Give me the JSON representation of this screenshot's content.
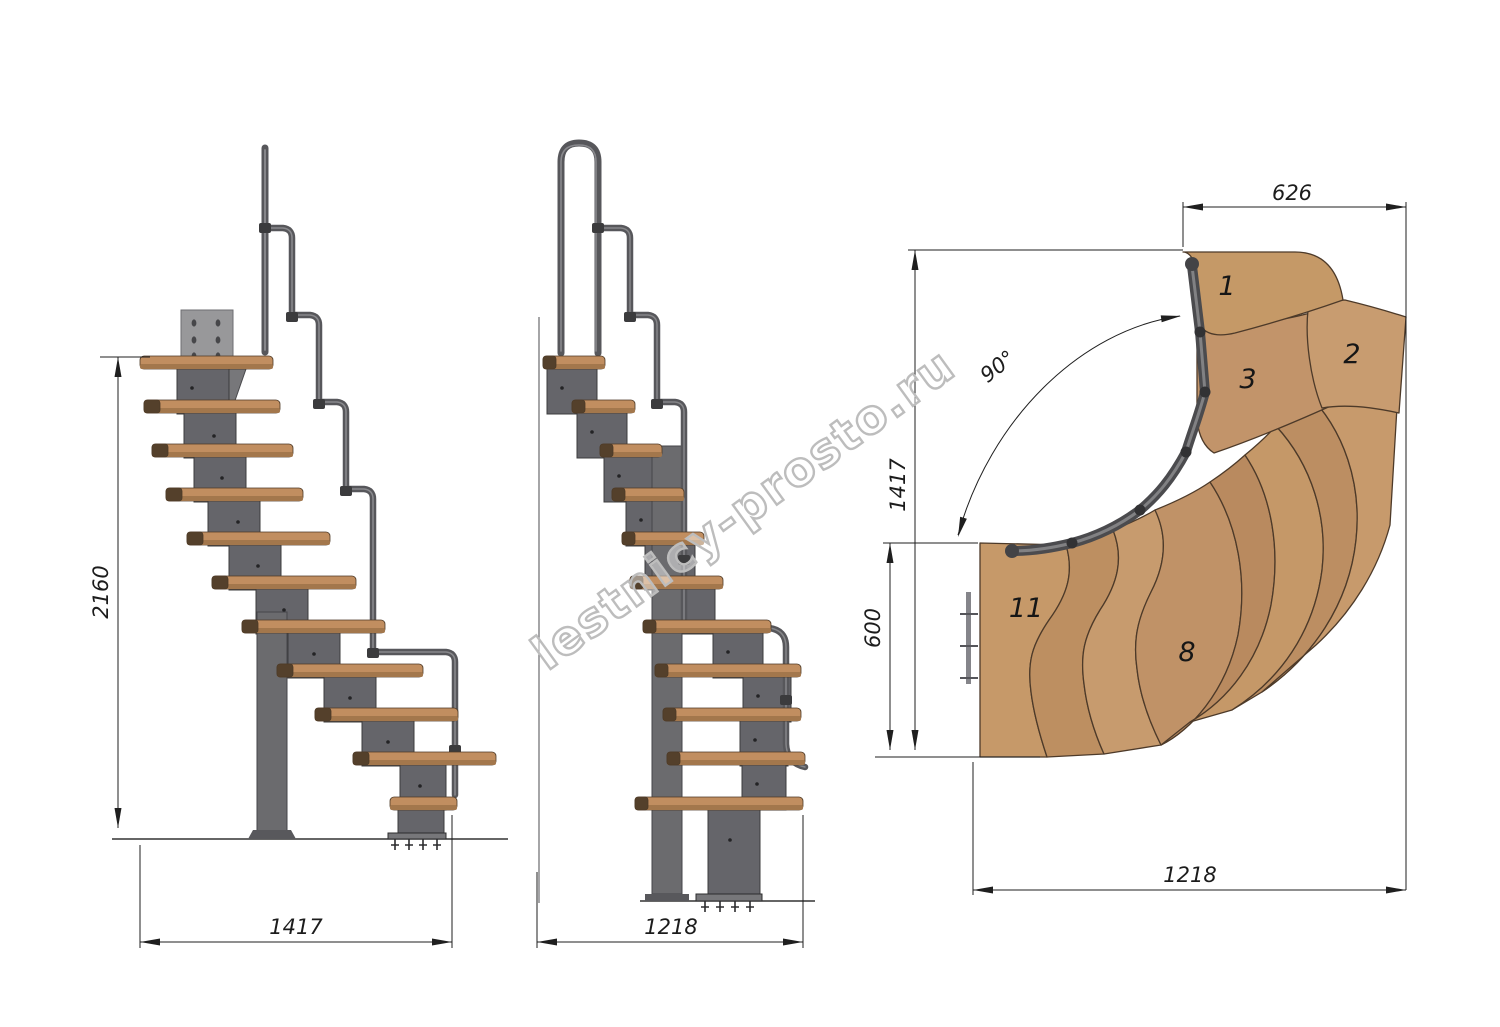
{
  "drawing_title": "Modular 90-degree turn staircase technical drawing",
  "watermark": {
    "text": "lestnicy-prosto.ru"
  },
  "views": {
    "side": {
      "height_dim": "2160",
      "width_dim": "1417"
    },
    "front": {
      "width_dim": "1218"
    },
    "plan": {
      "top_width_dim": "626",
      "flight_length_dim": "1417",
      "lower_width_dim": "600",
      "bottom_width_dim": "1218",
      "turn_angle": "90°",
      "tread_numbers": [
        "1",
        "2",
        "3",
        "8",
        "11"
      ]
    }
  },
  "colors": {
    "wood": "#c49363",
    "wood_dark_cap": "#54402b",
    "metal": "#5c5c60",
    "dimension_ink": "#1f1f1f",
    "background": "#ffffff"
  }
}
